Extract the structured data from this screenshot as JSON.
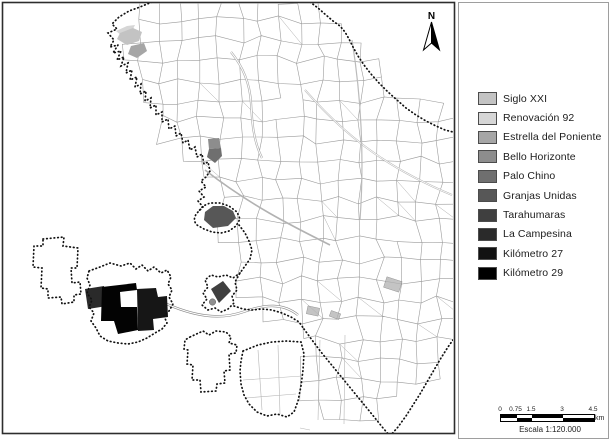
{
  "north_arrow": {
    "label": "N"
  },
  "legend": {
    "items": [
      {
        "id": "siglo-xxi",
        "label": "Siglo XXI",
        "color": "#c3c3c3"
      },
      {
        "id": "renovacion-92",
        "label": "Renovación 92",
        "color": "#d6d6d6"
      },
      {
        "id": "estrella-del-poniente",
        "label": "Estrella del Poniente",
        "color": "#a6a6a6"
      },
      {
        "id": "bello-horizonte",
        "label": "Bello Horizonte",
        "color": "#8d8d8d"
      },
      {
        "id": "palo-chino",
        "label": "Palo Chino",
        "color": "#6f6f6f"
      },
      {
        "id": "granjas-unidas",
        "label": "Granjas Unidas",
        "color": "#575757"
      },
      {
        "id": "tarahumaras",
        "label": "Tarahumaras",
        "color": "#3f3f3f"
      },
      {
        "id": "la-campesina",
        "label": "La Campesina",
        "color": "#2a2a2a"
      },
      {
        "id": "kilometro-27",
        "label": "Kilómetro 27",
        "color": "#121212"
      },
      {
        "id": "kilometro-29",
        "label": "Kilómetro 29",
        "color": "#000000"
      }
    ]
  },
  "scale_bar": {
    "ticks": [
      {
        "value": 0,
        "label": "0"
      },
      {
        "value": 0.75,
        "label": "0.75"
      },
      {
        "value": 1.5,
        "label": "1.5"
      },
      {
        "value": 3,
        "label": "3"
      },
      {
        "value": 4.5,
        "label": "4.5"
      }
    ],
    "total_km": 4.5,
    "bar_px": 93,
    "unit_label": "km",
    "caption": "Escala 1:120.000"
  },
  "map": {
    "classified_areas": [
      {
        "id": "renovacion-92",
        "label": "Renovación 92",
        "color": "#d6d6d6",
        "points": "116,31 127,26 135,25 132,31 122,36"
      },
      {
        "id": "siglo-xxi",
        "label": "Siglo XXI",
        "color": "#c3c3c3",
        "points": "120,33 133,28 142,32 139,41 127,45 117,39"
      },
      {
        "id": "estrella-del-poniente",
        "label": "Estrella del Poniente",
        "color": "#a6a6a6",
        "points": "131,46 144,43 147,51 137,58 128,54"
      },
      {
        "id": "bello-horizonte",
        "label": "Bello Horizonte",
        "color": "#8d8d8d",
        "points": "208,139 219,138 221,148 209,149"
      },
      {
        "id": "palo-chino",
        "label": "Palo Chino",
        "color": "#6f6f6f",
        "points": "209,149 221,148 222,156 215,163 207,157"
      },
      {
        "id": "granjas-unidas",
        "label": "Granjas Unidas",
        "color": "#575757",
        "points": "205,212 213,206 224,206 233,211 236,218 228,226 213,228 204,220"
      },
      {
        "id": "tarahumaras",
        "label": "Tarahumaras",
        "color": "#3f3f3f",
        "points": "211,289 223,281 231,291 219,303"
      },
      {
        "id": "la-campesina",
        "label": "La Campesina",
        "color": "#2a2a2a",
        "points": "85,289 104,286 107,306 88,309"
      },
      {
        "id": "kilometro-29",
        "label": "Kilómetro 29",
        "color": "#030303",
        "points": "102,287 136,283 137,290 120,292 121,307 137,307 138,330 118,334 114,321 101,321"
      },
      {
        "id": "kilometro-27",
        "label": "Kilómetro 27",
        "color": "#161616",
        "points": "137,289 156,288 158,297 167,296 168,317 153,319 154,330 138,331"
      }
    ],
    "marker": {
      "cx": 212.5,
      "cy": 302,
      "r": 3.2,
      "color": "#8f8f8f"
    }
  }
}
